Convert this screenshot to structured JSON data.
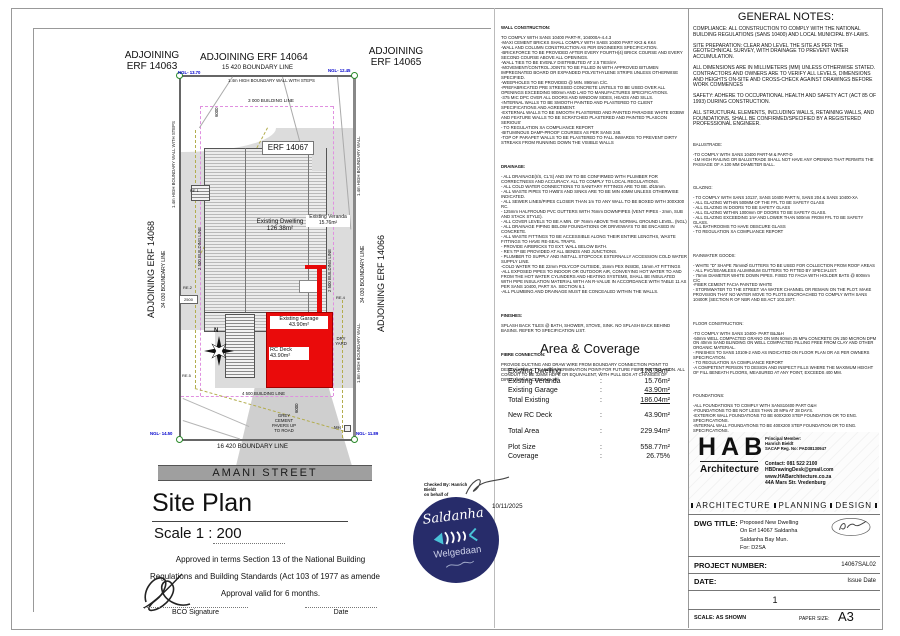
{
  "colors": {
    "accent_red": "#ea0b0b",
    "stamp_navy": "#272c6a",
    "ngl_blue": "#0000cc",
    "building_line_magenta": "#e090e0",
    "street_gray": "#9f9f9f"
  },
  "plan": {
    "north": "N",
    "adjoining_top_left": [
      "ADJOINING",
      "ERF 14063"
    ],
    "adjoining_top_mid": "ADJOINING ERF 14064",
    "adjoining_top_right": [
      "ADJOINING",
      "ERF 14065"
    ],
    "adjoining_left": "ADJOINING ERF 14068",
    "adjoining_right": "ADJOINING ERF 14066",
    "boundary_top": "15 420 BOUNDARY LINE",
    "boundary_bottom": "16 420 BOUNDARY LINE",
    "boundary_side": "34 030 BOUNDARY LINE",
    "wall_top": "1.4m HIGH BOUNDARY WALL WITH STEPS",
    "wall_right": "1.4m HIGH BOUNDARY WALL",
    "wall_right_lower": "1.8m HIGH BOUNDARY WALL",
    "building_line_3000": "3 000 BUILDING LINE",
    "building_line_2500": "2 500 BUILDING LINE",
    "building_line_4500": "4 500 BUILDING LINE",
    "erf_label": "ERF 14067",
    "dwelling": [
      "Existing Dwelling",
      "126.38m²"
    ],
    "veranda": [
      "Existing Veranda",
      "15.76m²"
    ],
    "garage": [
      "Existing Garage",
      "43.90m²"
    ],
    "rc_deck": [
      "RC Deck",
      "43.90m²"
    ],
    "dry_yard": [
      "DRY",
      "YARD"
    ],
    "pavers": [
      "GREY",
      "CEMENT",
      "PAVERS UP",
      "TO ROAD"
    ],
    "mh": "MH",
    "re1": "RE.1",
    "re2": "RE.2",
    "re4": "RE.4",
    "re5": "RE.5",
    "dim_6000": "6000",
    "dim_2500": "2500",
    "ngl_top_left": "NGL- 13.70",
    "ngl_top_right": "NGL- 12.45",
    "ngl_bottom_left": "NGL- 14.50",
    "ngl_bottom_right": "NGL- 11.89",
    "street": "AMANI STREET",
    "title": "Site Plan",
    "scale": "Scale  1 : 200"
  },
  "approval": {
    "line1": "Approved in terms Section 13 of the National Building",
    "line2": "Regulations and Building Standards (Act 103 of 1977 as amende",
    "line3": "Approval valid for 6 months.",
    "bco": "BCO Signature",
    "date": "Date"
  },
  "checked": {
    "lines": [
      "Checked By: Hanrich Bieldt",
      "on behalf of"
    ],
    "date": "10/11/2025"
  },
  "stamp": {
    "title": "Saldanha",
    "sub": "Welgedaan"
  },
  "notes_mid": {
    "wall": {
      "heading": "WALL CONSTRUCTION:",
      "body": [
        "TO COMPLY WITH SANS 10400 PART-R, 104000A-4.4.3",
        "-MAXI CEMENT BRICKS SHALL COMPLY WITH SABS 10400 PART KK3 & KK4",
        "-WALL AND COLUMN CONSTRUCTION AS PER ENGINEERS SPECIFICATION.",
        "-BRICKFORCE TO BE PROVIDED AFTER EVERY FOURTH(4) BRICK COURSE AND EVERY SECOND COURSE ABOVE ALL OPENINGS.",
        "-WALL TIES TO BE EVENLY DISTRIBUTED AT 2.5 TIES/m².",
        "-MOVEMENT/CONTROL JOINTS TO BE FILLED IN WITH APPROVED BITUMEN IMPREGNATED BOARD OR EXPANDED POLYETHYLENE STRIPS UNLESS OTHERWISE SPECIFIED.",
        "-WEEPHOLES TO BE PROVIDED @ MIN. 890mm C/C.",
        "-PREFABRICATED PRE STRESSED CONCRETE LINTELS TO BE USED OVER ALL OPENINGS EXCEEDING 900mm AND LAID TO MANUFACTURES SPECIFICATIONS.",
        "-375 MIC DPC OVER ALL DOORS AND WINDOW SIDES, HEADS AND SILLS.",
        "-INTERNAL WALLS TO BE SMOOTH PAINTED AND PLASTERED TO CLIENT SPECIFICATIONS AND AGREEMENT.",
        "-EXTERNAL WALLS TO BE SMOOTH PLASTERED AND PAINTED PARADISE WHITE E03BW AND FEATURE WALLS TO BE SCRATCHED PLASTERED AND PAINTED 'PLASCON SERIOUS'",
        "- TO REGULATION XA COMPLIANCE REPORT",
        "-BITUMINOUS DAMP-PROOF COURSES AS PER SANS 248.",
        "-TOP OF PARAPET WALLS TO BE PLASTERED TO FALL INWARDS TO PREVENT DIRTY STREAKS FROM RUNNING DOWN THE VISIBLE WALLS"
      ]
    },
    "drainage": {
      "heading": "DRAINAGE:",
      "body": [
        "- ALL DRAINAGE(I/S, CL'S) AND SW TO BE CONFIRMED WITH PLUMBER FOR CORRECTNESS AND ACCURACY.  ALL TO COMPLY TO LOCAL REGULATIONS.",
        "- ALL COLD WATER CONNECTIONS TO SANITARY FITTINGS ARE TO BE. Ø15mm.",
        "- ALL WASTE PIPES TO HWB'S AND SINKS ARE TO BE MIN 40MM UNLESS OTHERWISE INDICATED.",
        "- ALL SEWER LINES/PIPES CLOSER THAN 1m TO ANY WALL TO BE BOXED WITH 300X300 RC.",
        "- 125mm HALFROUND PVC GUTTERS WITH 76mm DOWNPIPES (VENT PIPES - 2mm, SUB AND STACK STYLE).",
        "- ALL COVER LEVELS TO BE A MIN. OF 76mm ABOVE THE NORMAL GROUND LEVEL. (NGL)",
        "- ALL DRAINAGE PIPING BELOW FOUNDATIONS OR DRIVEWAYS TO BE ENCASED IN CONCRETE.",
        "- ALL WASTE FITTINGS TO BE ACCESSIBLE ALONG THEIR ENTIRE LENGTHS, WASTE FITTINGS TO HAVE RE-SEAL TRAPS.",
        "- PROVIDE AIRBRICKS TO EXT. WALL BELOW BATH.",
        "- RE's TP BE PROVIDED AT ALL BENDS AND JUNCTIONS.",
        "- PLUMBER TO SUPPLY AND INSTALL STOPCOCK EXTERNALLY ACCESSION COLD WATER SUPPLY LINE.",
        "-COLD WATER TO BE 22mm POLYCOP OUTSIDE, 15mm PEX INSIDE, 15mm AT FITTINGS",
        "-ALL EXPOSED PIPES TO INDOOR OR OUTDOOR AIR, CONVEYING HOT WATER TO AND FROM THE HOT WATER CYLINDERS AND HEATING SYSTEMS, SHALL BE INSULATED WITH PIPE INSULATION MATERIAL WITH AN R-VALUE IN ACCORDANCE WITH TABLE 11 AS PER SANS 10400, PART XA. SECTION 6.1",
        "-ALL PLUMBING AND DRAINAGE MUST BE CONCEALED WITHIN THE WALLS."
      ]
    },
    "finishes": {
      "heading": "FINISHES:",
      "body": [
        "SPLASH BACK TILES @ BATH, SHOWER, STOVE, SINK. NO SPLASH BACK BEHIND BASINS. REFER TO SPECIFICATION LIST."
      ]
    },
    "fibre": {
      "heading": "FIBRE CONNECTION:",
      "body": [
        "PROVIDE DUCTING AND DRAW WIRE FROM BOUNDARY CONNECTION POINT TO DESIGNATED ICT CABINET/TERMINATION POINT FOR FUTURE FIBRE INSTALLATION. ALL CONDUIT TO BE 32MM HDPE OR EQUIVALENT, WITH PULL BOX AT CHANGES OF DIRECTION EXCEEDING 30°"
      ]
    }
  },
  "area": {
    "heading": "Area & Coverage",
    "sep": ":",
    "rows": [
      {
        "label": "Existing Dwelling",
        "value": "126.38m²"
      },
      {
        "label": "Existing Veranda",
        "value": "15.76m²"
      },
      {
        "label": "Existing Garage",
        "value": "43.90m²"
      },
      {
        "label": "Total Existing",
        "value": "186.04m²"
      },
      {
        "label": "New RC Deck",
        "value": "43.90m²"
      },
      {
        "label": "Total Area",
        "value": "229.94m²"
      },
      {
        "label": "Plot Size",
        "value": "558.77m²"
      },
      {
        "label": "Coverage",
        "value": "26.75%"
      }
    ]
  },
  "general_notes": {
    "heading": "GENERAL NOTES:",
    "paragraphs": [
      "COMPLIANCE: ALL CONSTRUCTION TO COMPLY WITH THE NATIONAL BUILDING REGULATIONS (SANS 10400) AND LOCAL MUNICIPAL BY-LAWS.",
      "SITE PREPARATION: CLEAR AND LEVEL THE SITE AS PER THE GEOTECHNICAL SURVEY, WITH DRAINAGE TO PREVENT WATER ACCUMULATION.",
      "ALL DIMENSIONS ARE IN MILLIMETERS (MM) UNLESS OTHERWISE STATED. CONTRACTORS AND OWNERS ARE TO VERIFY ALL LEVELS, DIMENSIONS AND HEIGHTS ON-SITE AND CROSS-CHECK AGAINST DRAWINGS BEFORE WORK COMMENCES",
      "SAFETY: ADHERE TO OCCUPATIONAL HEALTH AND SAFETY ACT (ACT 85 OF 1993) DURING CONSTRUCTION.",
      "ALL STRUCTURAL ELEMENTS, INCLUDING WALLS, RETAINING WALLS, AND FOUNDATIONS, SHALL BE CONFIRMED/SPECIFIED BY A REGISTERED PROFESSIONAL ENGINEER."
    ],
    "balustrade": {
      "heading": "BALUSTRADE:",
      "body": [
        "-TO COMPLY WITH SANS 10400 PART-M & PART-D",
        "-1M HIGH RAILING OR BALUSTRADE SHALL NOT HAVE ANY OPENING THAT PERMITS THE PASSAGE OF A 100 MM DIAMETER BALL."
      ]
    },
    "glazing": {
      "heading": "GLAZING:",
      "body": [
        "- TO COMPLY WITH SANS 10137, SANS 10400 PART N, SANS 204 & SANS 10400-XA",
        "- ALL GLAZING WITHIN 500MM OF THE FFL TO BE SAFETY GLASS",
        "- ALL GLAZING IN DOORS TO BE SAFETY GLASS",
        "- ALL GLAZING WITHIN 1000mm OF DOORS TO BE SAFETY GLASS.",
        "- ALL GLAZING EXCEEDING 1m² AND LOWER THAN 500mm FROM FFL TO BE SAFETY GLASS.",
        "-ALL BATHROOMS TO HAVE OBSCURE GLASS",
        "- TO REGULATION XA COMPLIANCE REPORT"
      ]
    },
    "rainwater": {
      "heading": "RAINWATER GOODS:",
      "body": [
        "- WHITE \"D\" SHAPE 75mmØ GUTTERS TO BE USED FOR COLLECTION FROM ROOF AREAS",
        "- ALL PVC/SEAMLESS ALUMINIUM GUTTERS TO FITTED BY SPECIALIST.",
        "- 75mm DIAMETER WHITE DOWN PIPES. FIXED TO FACIA WITH HOLDER BATS @ 800mm C/C",
        "-FIBER CEMENT FACIA PAINTED WHITE",
        "- STORMWATER TO THE STREET VIA WATER CHANNEL OR REMAIN ON THE PLOT. MAKE PROVISION THAT NO WATER MOVE TO PLOTS ENCROACHED TO COMPLY WITH SANS 10400R (SECTION R OF NBR AND BS ACT 103.1977."
      ]
    },
    "floor": {
      "heading": "FLOOR CONSTRUCTION:",
      "body": [
        "-TO COMPLY WITH SANS 10400- PART B&J&H",
        "-50mm WELL COMPACTED GRANO ON MIN 80mm 25 MPa CONCRETE ON 250 MICRON DPM ON 40mm SAND BLINDING ON WELL COMPACTED FILLING FREE FROM CLAY AND OTHER ORGANIC MATERIAL.",
        "- FINISHES TO SANS 10109-2 AND AS INDICATED ON FLOOR PLAN OR AS PER OWNERS SPECIFICATION.",
        "- TO REGULATION XA COMPLIANCE REPORT",
        "-A COMPETENT PERSON TO DESIGN AND INSPECT FILLS WHERE THE MAXIMUM HEIGHT OF FILL BENEATH FLOORS, MEASURED AT ANY POINT, EXCEEDS 400 MM."
      ]
    },
    "foundations": {
      "heading": "FOUNDATIONS:",
      "body": [
        "-ALL FOUNDATIONS TO COMPLY WITH SANS10400 PART G&H",
        "-FOUNDATIONS TO BE NOT LESS THAN 20 MPa AT 28 DAYS.",
        "-EXTERIOR WALL FOUNDATIONS TO BE 600X200 STEP FOUNDATION OR TO ENG. SPECIFICATIONS.",
        "-INTERNAL WALL FOUNDATIONS TO BE 400X200 STEP FOUNDATION OR TO ENG. SPECIFICATIONS.",
        "-3X Y12 REINFORCING STEEL TO BE INSERTED IN FOUNDATIONS SPACED 100MM C/C WITH MINIMUM 50MM COVERING.",
        "-BRICKFORCE SHALL BE PROVIDED IN EVERY COURSE IN FOUNDATION BRICKWORK.",
        "-RETAINING WALL FOUNDATIONS AS PER SANS10400 PART H 4.4."
      ]
    }
  },
  "title_block": {
    "logo": "HAB",
    "logo_sub": "Architecture",
    "principal": [
      "Principal Member:",
      "Hanrich Bieldt",
      "SACAP Reg. No: PAD38130947"
    ],
    "contact": [
      "Contact: 081 522 2100",
      "HBDrawingDesk@gmail.com",
      "www.HABarchitecture.co.za",
      "44A Mars Str. Vredenburg"
    ],
    "services": {
      "a": "ARCHITECTURE",
      "b": "PLANNING",
      "c": "DESIGN"
    },
    "dwg_label": "DWG TITLE:",
    "dwg_lines": [
      "Proposed New Dwelling",
      "On Erf 14067 Saldanha",
      "Saldanha Bay Mun.",
      "For: D2SA"
    ],
    "project_label": "PROJECT NUMBER:",
    "project_value": "14067SAL02",
    "date_label": "DATE:",
    "date_value": "Issue Date",
    "sheet": "1",
    "scale_text": "SCALE: AS SHOWN",
    "paper_label": "PAPER SIZE:",
    "paper_value": "A3"
  }
}
